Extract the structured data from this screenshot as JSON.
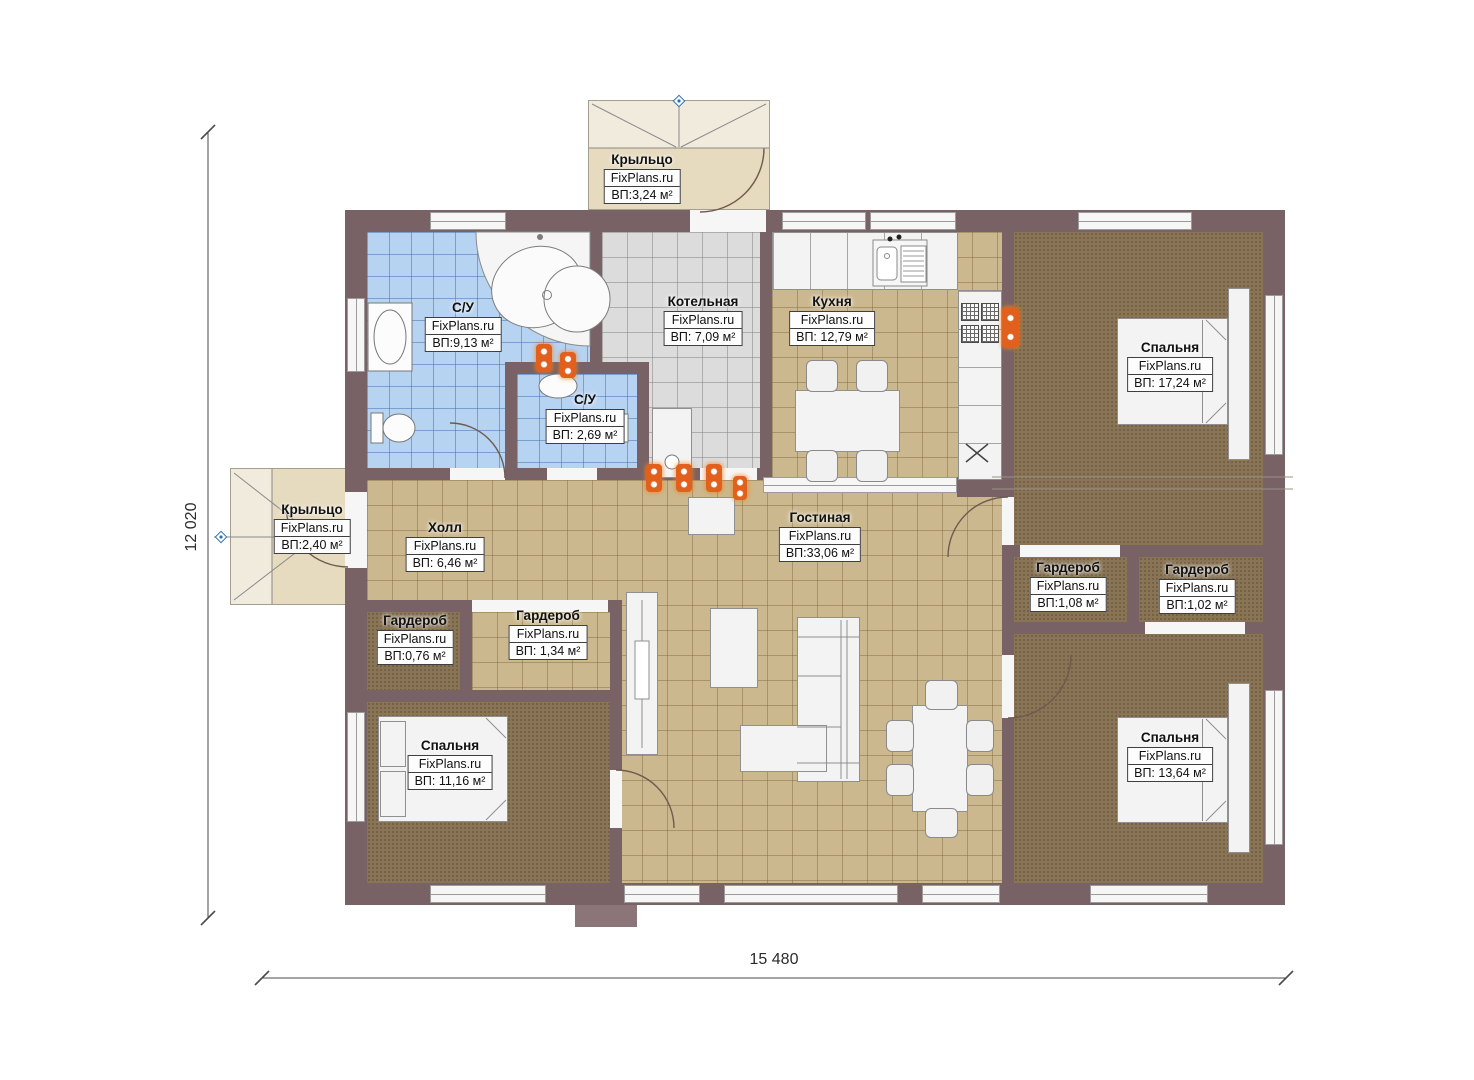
{
  "brand": "FixPlans.ru",
  "plan": {
    "dimension_width": "15 480",
    "dimension_height": "12 020"
  },
  "rooms": {
    "porch_top": {
      "name": "Крыльцо",
      "area": "ВП:3,24 м²"
    },
    "bathroom": {
      "name": "С/У",
      "area": "ВП:9,13 м²"
    },
    "wc": {
      "name": "С/У",
      "area": "ВП: 2,69 м²"
    },
    "boiler": {
      "name": "Котельная",
      "area": "ВП: 7,09 м²"
    },
    "kitchen": {
      "name": "Кухня",
      "area": "ВП: 12,79 м²"
    },
    "bedroom_ne": {
      "name": "Спальня",
      "area": "ВП: 17,24 м²"
    },
    "porch_left": {
      "name": "Крыльцо",
      "area": "ВП:2,40 м²"
    },
    "hall": {
      "name": "Холл",
      "area": "ВП: 6,46 м²"
    },
    "living": {
      "name": "Гостиная",
      "area": "ВП:33,06 м²"
    },
    "wardrobe_e1": {
      "name": "Гардероб",
      "area": "ВП:1,08 м²"
    },
    "wardrobe_e2": {
      "name": "Гардероб",
      "area": "ВП:1,02 м²"
    },
    "wardrobe_w1": {
      "name": "Гардероб",
      "area": "ВП:0,76 м²"
    },
    "wardrobe_w2": {
      "name": "Гардероб",
      "area": "ВП: 1,34 м²"
    },
    "bedroom_sw": {
      "name": "Спальня",
      "area": "ВП: 11,16 м²"
    },
    "bedroom_se": {
      "name": "Спальня",
      "area": "ВП: 13,64 м²"
    }
  },
  "colors": {
    "wall": "#786265",
    "floor_tile_tan": "#ccb88e",
    "floor_tile_blue": "#b7d3f2",
    "floor_tile_gray": "#dcdcdc",
    "floor_carpet": "#897455",
    "porch": "#e6dabf",
    "radiator_orange": "#e2601d",
    "entry_marker_blue": "#2f6fb4"
  }
}
